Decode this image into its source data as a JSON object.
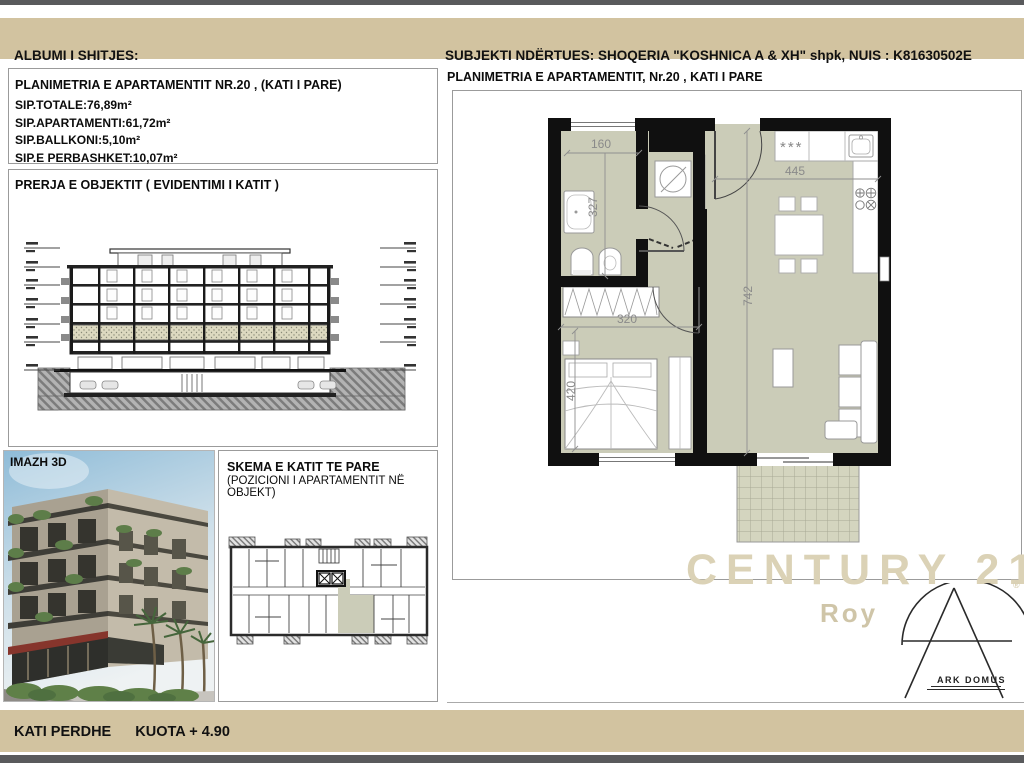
{
  "header": {
    "left": "ALBUMI I SHITJES:",
    "right": "SUBJEKTI NDËRTUES:  SHOQERIA \"KOSHNICA A & XH\" shpk, NUIS : K81630502E"
  },
  "info_panel": {
    "title": "PLANIMETRIA E APARTAMENTIT NR.20 , (KATI I PARE)",
    "lines": [
      "SIP.TOTALE:76,89m²",
      "SIP.APARTAMENTI:61,72m²",
      "SIP.BALLKONI:5,10m²",
      "SIP.E PERBASHKET:10,07m²"
    ]
  },
  "section_panel": {
    "title": "PRERJA E OBJEKTIT ( EVIDENTIMI I KATIT )"
  },
  "image_panel": {
    "label": "IMAZH 3D"
  },
  "schema_panel": {
    "title": "SKEMA E KATIT TE PARE",
    "subtitle": "(POZICIONI I APARTAMENTIT NË OBJEKT)"
  },
  "plan_panel": {
    "title": "PLANIMETRIA E APARTAMENTIT, Nr.20 , KATI I PARE",
    "dims": {
      "bath_window": "160",
      "bath_depth": "327",
      "kitchen_width": "445",
      "living_depth": "742",
      "hall_width": "320",
      "bedroom_depth": "420"
    },
    "kitchen_marks": "***"
  },
  "watermark": {
    "brand": "CENTURY 21",
    "registered": "®",
    "sub_brand": "Roy"
  },
  "logo": {
    "text": "ARK DOMUS"
  },
  "footer": {
    "left": "KATI PERDHE",
    "right": "KUOTA + 4.90"
  },
  "colors": {
    "band_tan": "#d2c3a0",
    "dark_strip": "#595a5c",
    "floor_beige": "#cbccb8",
    "tile_beige": "#d4d5bf",
    "wall_black": "#101010",
    "watermark_beige": "#dbd2b6"
  }
}
